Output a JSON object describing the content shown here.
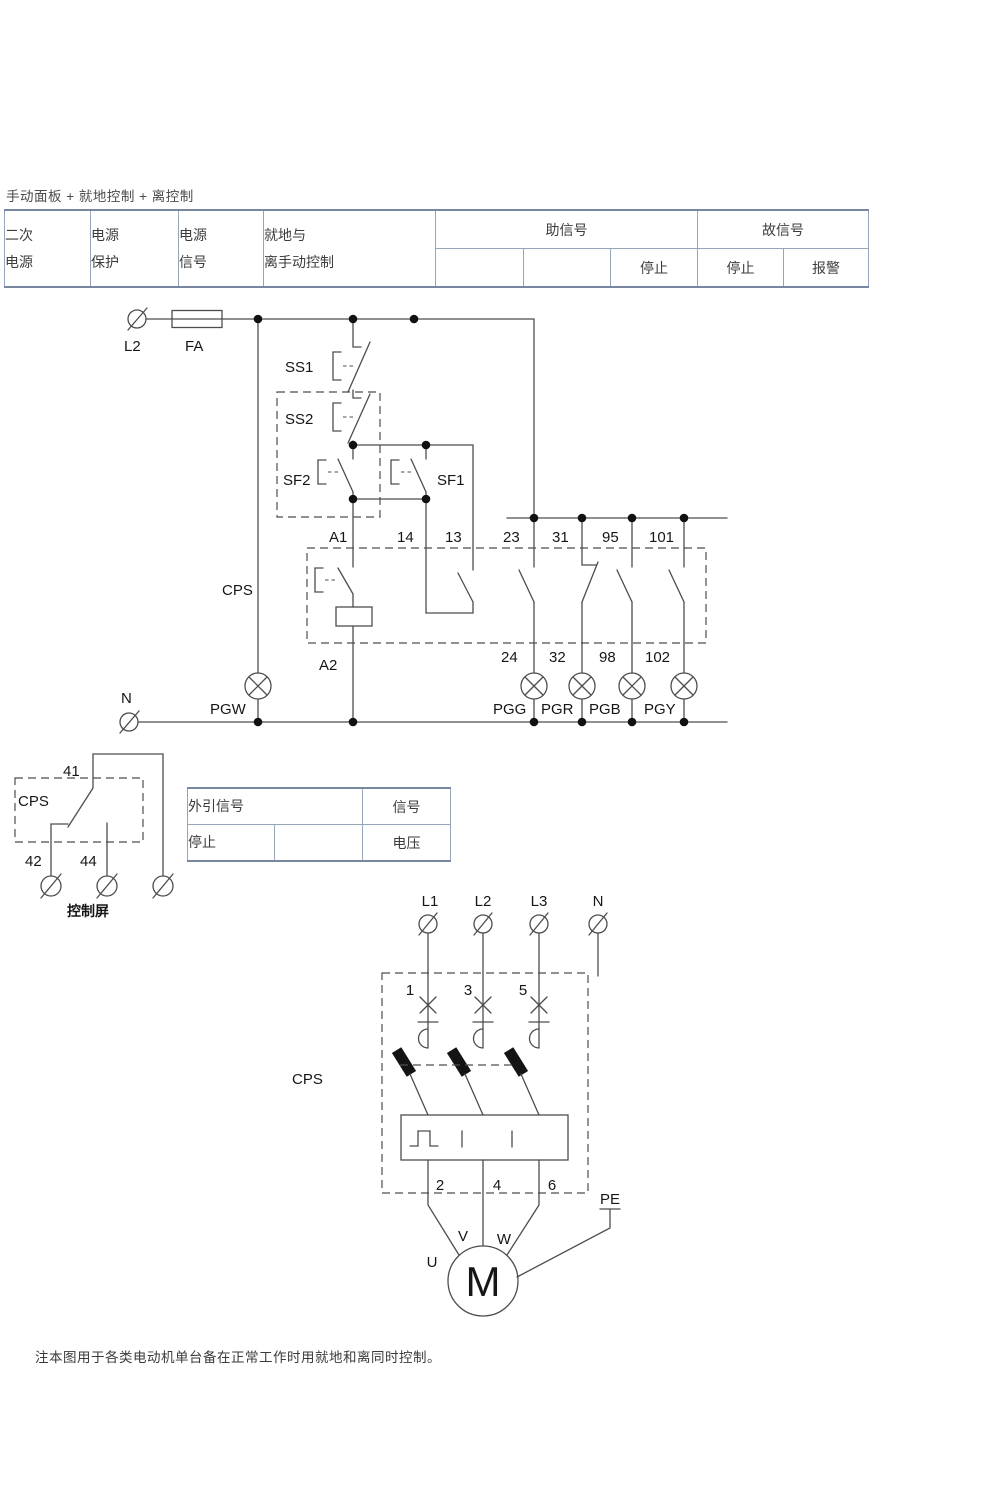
{
  "page": {
    "title": "手动面板 + 就地控制 + 离控制",
    "note": "注本图用于各类电动机单台备在正常工作时用就地和离同时控制。"
  },
  "signal_table": {
    "headers": {
      "col1_line1": "二次",
      "col1_line2": "电源",
      "col2_line1": "电源",
      "col2_line2": "保护",
      "col3_line1": "电源",
      "col3_line2": "信号",
      "col4_line1": "就地与",
      "col4_line2": "离手动控制",
      "group_aux": "助信号",
      "group_fault": "故信号"
    },
    "subcells": {
      "aux_stop": "停止",
      "fault_stop": "停止",
      "fault_alarm": "报警"
    }
  },
  "control_circuit": {
    "terminal_l2": "L2",
    "fuse": "FA",
    "ss1": "SS1",
    "ss2": "SS2",
    "sf2": "SF2",
    "sf1": "SF1",
    "cps": "CPS",
    "coil_a1": "A1",
    "coil_a2": "A2",
    "t14": "14",
    "t13": "13",
    "t23": "23",
    "t24": "24",
    "t31": "31",
    "t32": "32",
    "t95": "95",
    "t98": "98",
    "t101": "101",
    "t102": "102",
    "lamp_pgw": "PGW",
    "lamp_pgg": "PGG",
    "lamp_pgr": "PGR",
    "lamp_pgb": "PGB",
    "lamp_pgy": "PGY",
    "neutral": "N"
  },
  "panel_circuit": {
    "t41": "41",
    "cps": "CPS",
    "t42": "42",
    "t44": "44",
    "caption": "控制屏"
  },
  "ext_table": {
    "title": "外引信号",
    "signal": "信号",
    "stop": "停止",
    "voltage": "电压"
  },
  "power_circuit": {
    "l1": "L1",
    "l2": "L2",
    "l3": "L3",
    "n": "N",
    "t1": "1",
    "t3": "3",
    "t5": "5",
    "cps": "CPS",
    "t2": "2",
    "t4": "4",
    "t6": "6",
    "pe": "PE",
    "u": "U",
    "v": "V",
    "w": "W",
    "motor": "M"
  },
  "colors": {
    "wire": "#4d4d4d",
    "table_border_inner": "#97a5bb",
    "table_border_outer": "#77879f",
    "text": "#161616",
    "muted_text": "#8a8a8a"
  }
}
